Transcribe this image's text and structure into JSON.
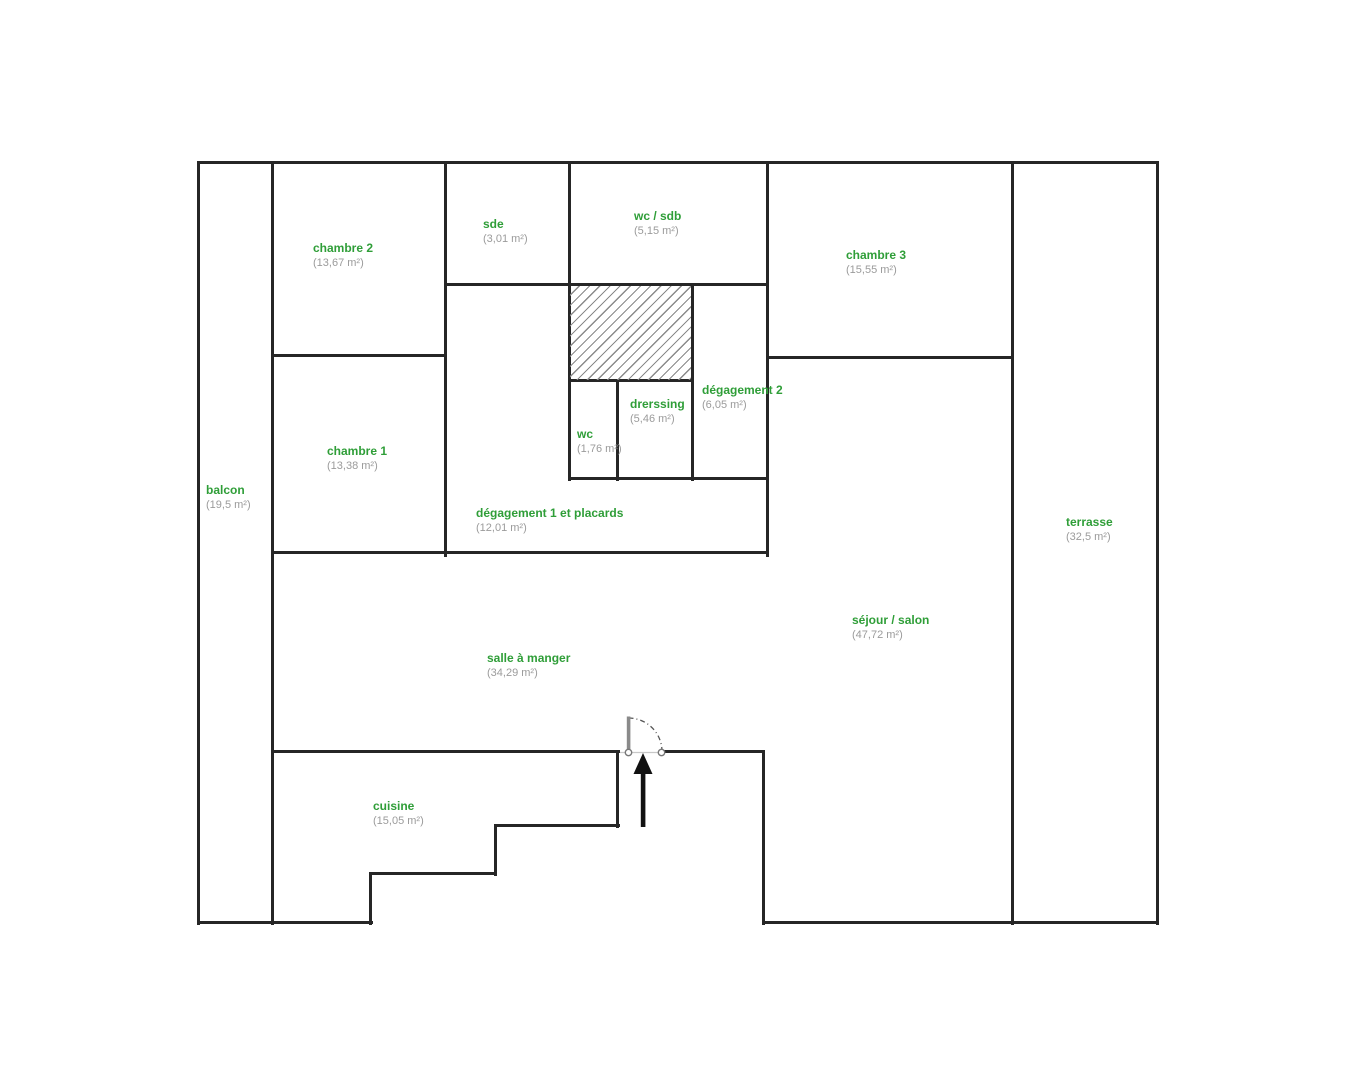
{
  "plan_title": "floor-plan",
  "colors": {
    "room_name": "#2f9e38",
    "room_area": "#9b9b9b",
    "wall": "#262626",
    "door": "#8a8a8a",
    "arrow": "#111111",
    "hatch_line": "#8a8a8a",
    "background": "#ffffff"
  },
  "icons": {
    "entrance_arrow": "up-arrow",
    "door_swing": "quarter-arc"
  },
  "rooms": {
    "balcon": {
      "name": "balcon",
      "area": "(19,5 m²)"
    },
    "chambre2": {
      "name": "chambre 2",
      "area": "(13,67 m²)"
    },
    "sde": {
      "name": "sde",
      "area": "(3,01 m²)"
    },
    "wc_sdb": {
      "name": "wc / sdb",
      "area": "(5,15 m²)"
    },
    "chambre3": {
      "name": "chambre 3",
      "area": "(15,55 m²)"
    },
    "chambre1": {
      "name": "chambre 1",
      "area": "(13,38 m²)"
    },
    "degagement2": {
      "name": "dégagement 2",
      "area": "(6,05 m²)"
    },
    "dressing": {
      "name": "drerssing",
      "area": "(5,46 m²)"
    },
    "wc": {
      "name": "wc",
      "area": "(1,76 m²)"
    },
    "degagement1": {
      "name": "dégagement 1 et placards",
      "area": "(12,01 m²)"
    },
    "salle_a_manger": {
      "name": "salle à manger",
      "area": "(34,29 m²)"
    },
    "sejour_salon": {
      "name": "séjour / salon",
      "area": "(47,72 m²)"
    },
    "cuisine": {
      "name": "cuisine",
      "area": "(15,05 m²)"
    },
    "terrasse": {
      "name": "terrasse",
      "area": "(32,5 m²)"
    }
  }
}
